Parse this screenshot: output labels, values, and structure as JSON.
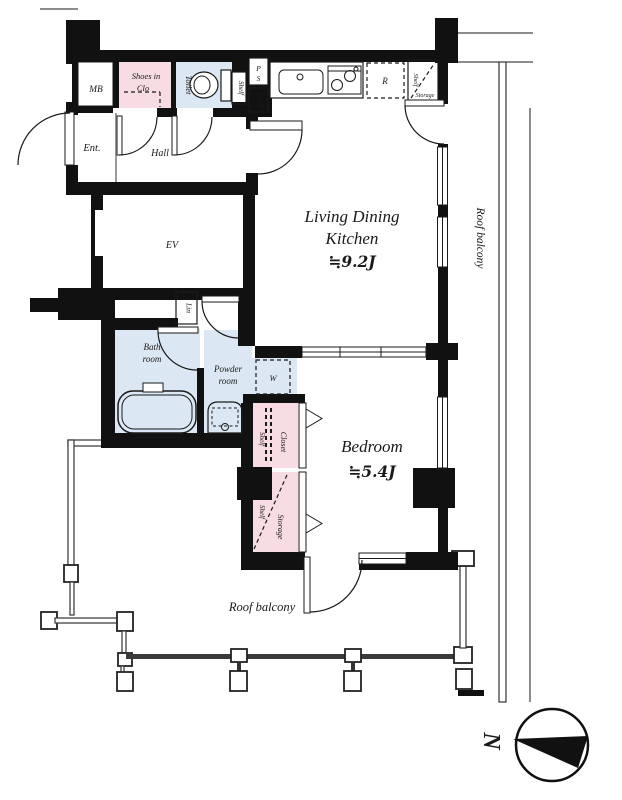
{
  "title": "Japanese apartment floor plan 1LDK",
  "colors": {
    "wall": "#111111",
    "closet_pink": "#f7dce3",
    "wet_area_blue": "#dbe8f3",
    "railing_gray": "#444444"
  },
  "labels": {
    "mb": "MB",
    "shoes_line1": "Shoes in",
    "shoes_line2": "Clo",
    "toilet": "Toilet",
    "ps_p": "P",
    "ps_s": "S",
    "shelf": "Shelf",
    "storage": "Storage",
    "refrigerator": "R",
    "ent": "Ent.",
    "hall": "Hall",
    "ev": "EV",
    "ldk_line1": "Living Dining",
    "ldk_line2": "Kitchen",
    "ldk_area": "≒9.2J",
    "lin": "Lin",
    "bath_line1": "Bath",
    "bath_line2": "room",
    "powder_line1": "Powder",
    "powder_line2": "room",
    "washer": "W",
    "closet": "Closet",
    "bedroom": "Bedroom",
    "bedroom_area": "≒5.4J",
    "roof_balcony": "Roof balcony",
    "north": "N"
  }
}
